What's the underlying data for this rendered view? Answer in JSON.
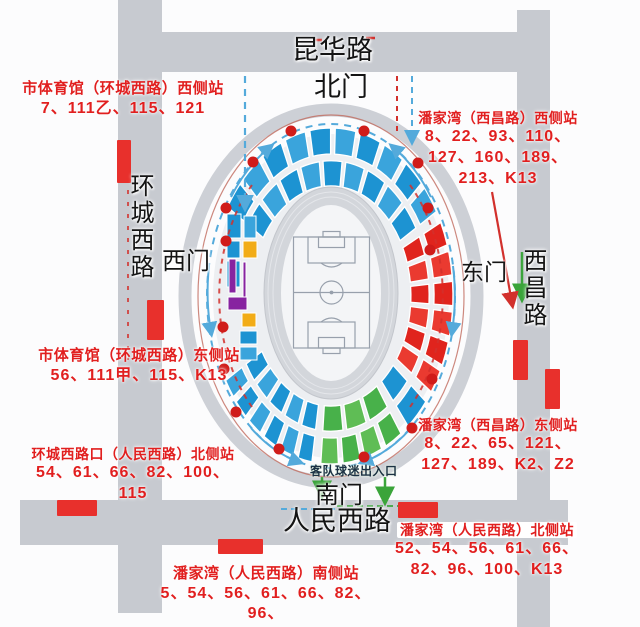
{
  "roads": {
    "top": "昆华路",
    "left": "环城西路",
    "right": "西昌路",
    "bottom": "人民西路"
  },
  "gates": {
    "north": "北门",
    "south": "南门",
    "east": "东门",
    "west": "西门"
  },
  "stadium": {
    "away_fans_entrance": "客队球迷出入口"
  },
  "bus_stops": [
    {
      "name": "市体育馆（环城西路）西侧站",
      "routes": [
        "7、111乙、115、121"
      ]
    },
    {
      "name": "潘家湾（西昌路）西侧站",
      "routes": [
        "8、22、93、110、",
        "127、160、189、",
        "213、K13"
      ]
    },
    {
      "name": "市体育馆（环城西路）东侧站",
      "routes": [
        "56、111甲、115、K13"
      ]
    },
    {
      "name": "环城西路口（人民西路）北侧站",
      "routes": [
        "54、61、66、82、100、115"
      ]
    },
    {
      "name": "潘家湾（西昌路）东侧站",
      "routes": [
        "8、22、65、121、",
        "127、189、K2、Z2"
      ]
    },
    {
      "name": "潘家湾（人民西路）北侧站",
      "routes": [
        "52、54、56、61、66、",
        "82、96、100、K13"
      ]
    },
    {
      "name": "潘家湾（人民西路）南侧站",
      "routes": [
        "5、54、56、61、66、82、96、",
        "100、106、113、231、K13"
      ]
    }
  ],
  "colors": {
    "road_gray": "#c7cad0",
    "ring_gray": "#cdd0d6",
    "bowl": "#edeff2",
    "track": "#d3d6db",
    "field_bg": "#f4f5f7",
    "field_line": "#98a0ac",
    "seat_blue": "#1d93d2",
    "seat_blue_alt": "#3aa4dc",
    "seat_red": "#e0241d",
    "seat_red_alt": "#ea3a30",
    "seat_green": "#48b14a",
    "seat_green_alt": "#5fbd55",
    "seat_yellow": "#f2ac17",
    "seat_purple": "#8723a0",
    "stop_red": "#e8302c",
    "dot_red": "#d01c1a",
    "text_red": "#e11f1f",
    "text_black": "#141414",
    "path_blue": "#54aadb",
    "path_red": "#d2302c",
    "arrow_green": "#3aa43a",
    "fence": "#c06a5e"
  }
}
